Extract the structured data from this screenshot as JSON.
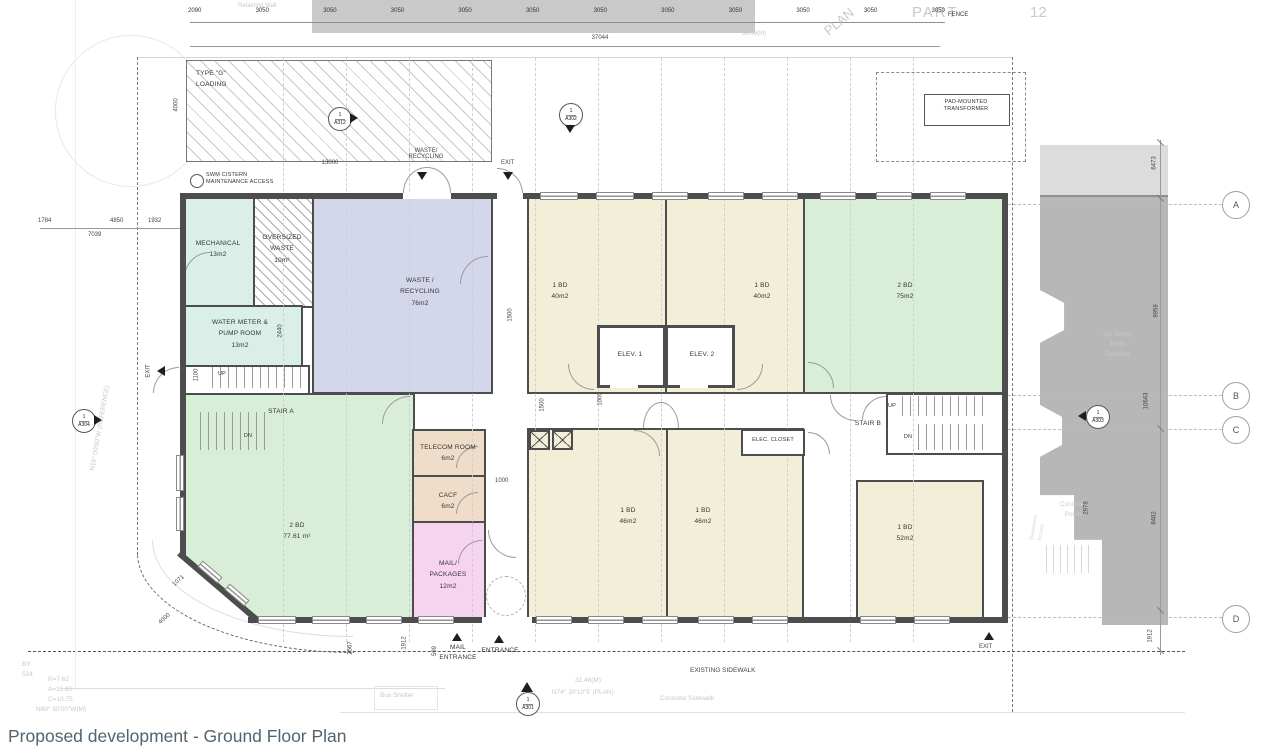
{
  "caption": "Proposed development - Ground Floor Plan",
  "colors": {
    "wall": "#4d4d4d",
    "mint": "#d9efe7",
    "lavender": "#d4d7ec",
    "green": "#d9eed6",
    "cream": "#f2eed7",
    "tan": "#efddc9",
    "pink": "#f6d3ef",
    "existing_building": "#b7b7b7",
    "existing_light": "#dcdcdc",
    "caption_color": "#51646f"
  },
  "rooms": {
    "mechanical": "MECHANICAL\n13m2",
    "oversized_waste": "OVERSIZED\nWASTE\n10m²",
    "waste_recycling": "WASTE /\nRECYCLING\n76m2",
    "water_meter": "WATER METER &\nPUMP ROOM\n13m2",
    "stair_a": "STAIR A",
    "stair_b": "STAIR B",
    "bd2_77": "2 BD\n77.61 m²",
    "telecom": "TELECOM ROOM\n6m2",
    "cacf": "CACF\n6m2",
    "mail": "MAIL/\nPACKAGES\n12m2",
    "bd1_40a": "1 BD\n40m2",
    "bd1_40b": "1 BD\n40m2",
    "bd2_75": "2 BD\n75m2",
    "bd1_46a": "1 BD\n46m2",
    "bd1_46b": "1 BD\n46m2",
    "bd1_52": "1 BD\n52m2",
    "elev1": "ELEV. 1",
    "elev2": "ELEV. 2",
    "elec_closet": "ELEC. CLOSET",
    "up": "UP",
    "dn": "DN"
  },
  "site": {
    "loading": "TYPE \"G\"\nLOADING",
    "swm": "SWM CISTERN\nMAINTENANCE ACCESS",
    "transformer": "PAD-MOUNTED\nTRANSFORMER",
    "waste_door": "WASTE/\nRECYCLING",
    "exit": "EXIT",
    "mail_entrance": "MAIL\nENTRANCE",
    "entrance": "ENTRANCE",
    "sidewalk": "EXISTING SIDEWALK",
    "fence": "FENCE"
  },
  "markers": {
    "a301": {
      "num": "1",
      "sheet": "A301"
    },
    "a302": {
      "num": "1",
      "sheet": "A302"
    },
    "a303": {
      "num": "1",
      "sheet": "A303"
    },
    "a304": {
      "num": "1",
      "sheet": "A304"
    },
    "a312": {
      "num": "1",
      "sheet": "A312"
    }
  },
  "grid": {
    "a": "A",
    "b": "B",
    "c": "C",
    "d": "D"
  },
  "dims": {
    "top": [
      "2090",
      "3050",
      "3050",
      "3050",
      "3050",
      "3050",
      "3050",
      "3050",
      "3050",
      "3050",
      "3050",
      "3050"
    ],
    "top_total": "37044",
    "left": [
      "1784",
      "4850",
      "1932",
      "7039"
    ],
    "loading_w": "13000",
    "loading_h": "4000",
    "stair_w": "1100",
    "pump_d": "2440",
    "corr": [
      "1500",
      "1500",
      "1000",
      "1000"
    ],
    "right": [
      "6473",
      "9959",
      "10643",
      "8482",
      "2978",
      "1912"
    ],
    "bottom": [
      "2567",
      "1912",
      "599"
    ],
    "chamfer": [
      "1071",
      "4000"
    ]
  },
  "survey": {
    "part": "PART",
    "lot12": "12",
    "plan_word": "PLAN",
    "retaining": "Retaining Wall",
    "dist_top": "39.09(M)",
    "dist_bottom": "31.46(M)",
    "bearing_bottom": "N74° 20'10\"E (PLAN)",
    "concrete_sidewalk": "Concrete  Sidewalk",
    "bus_shelter": "Bus Shelter",
    "by_lot": "BY\n524",
    "curve_data": "R=7.62\nA=11.93\nC=10.75",
    "bearing_curve": "N60° 50'00\"W(M)",
    "bearing_left": "N16° 00'00\"W (REFERENCE)",
    "dwelling": "2½ Storey\nBrick\nDwelling",
    "porch": "Concrete\nPorch",
    "basement": "Basement\nAccess"
  }
}
